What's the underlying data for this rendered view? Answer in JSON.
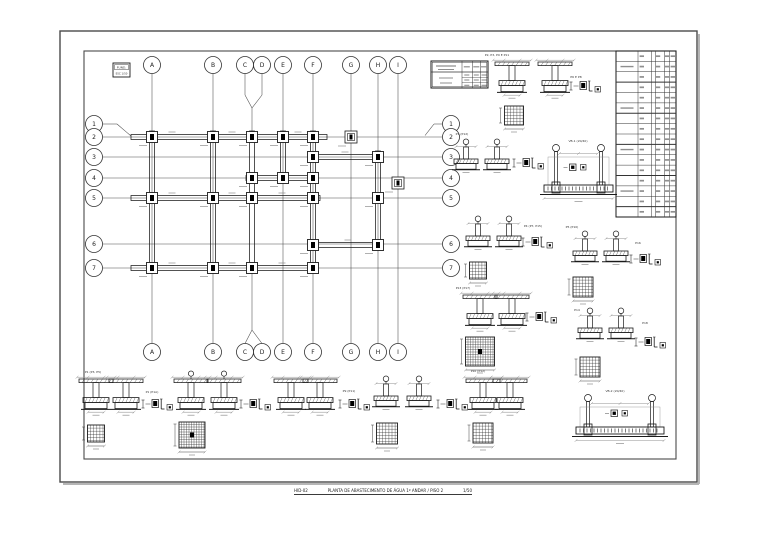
{
  "sheet": {
    "caption": {
      "code": "HID-02",
      "title": "PLANTA DE ABASTECIMENTO DE ÁGUA 1º ANDAR / PISO 2",
      "scale": "1/50"
    },
    "legend_box": {
      "line1": "FUND.",
      "line2": "ESC 1/50"
    }
  },
  "grid": {
    "columns": [
      "A",
      "B",
      "C",
      "D",
      "E",
      "F",
      "G",
      "H",
      "I"
    ],
    "rows": [
      "1",
      "2",
      "3",
      "4",
      "5",
      "6",
      "7"
    ]
  },
  "details": {
    "labels": [
      "P2, P3, P9 E P11",
      "P6 E P8",
      "P1 (P12)",
      "VB-1 (20/40)",
      "P4 (P7, P15)",
      "P5 (P10)",
      "P16",
      "P13 (P17)",
      "P14",
      "P18",
      "P1 (P3, P5)",
      "P1 (P1A)",
      "P9 (P11)",
      "P10 (P12)",
      "VB-2 (20/40)"
    ]
  },
  "colors": {
    "line": "#1a1a1a",
    "grid": "#4a4a4a",
    "dim": "#909090",
    "marker": "#000000",
    "paper": "#ffffff",
    "shadow": "#b5b5b5",
    "smudge": "#8f8f8f"
  }
}
